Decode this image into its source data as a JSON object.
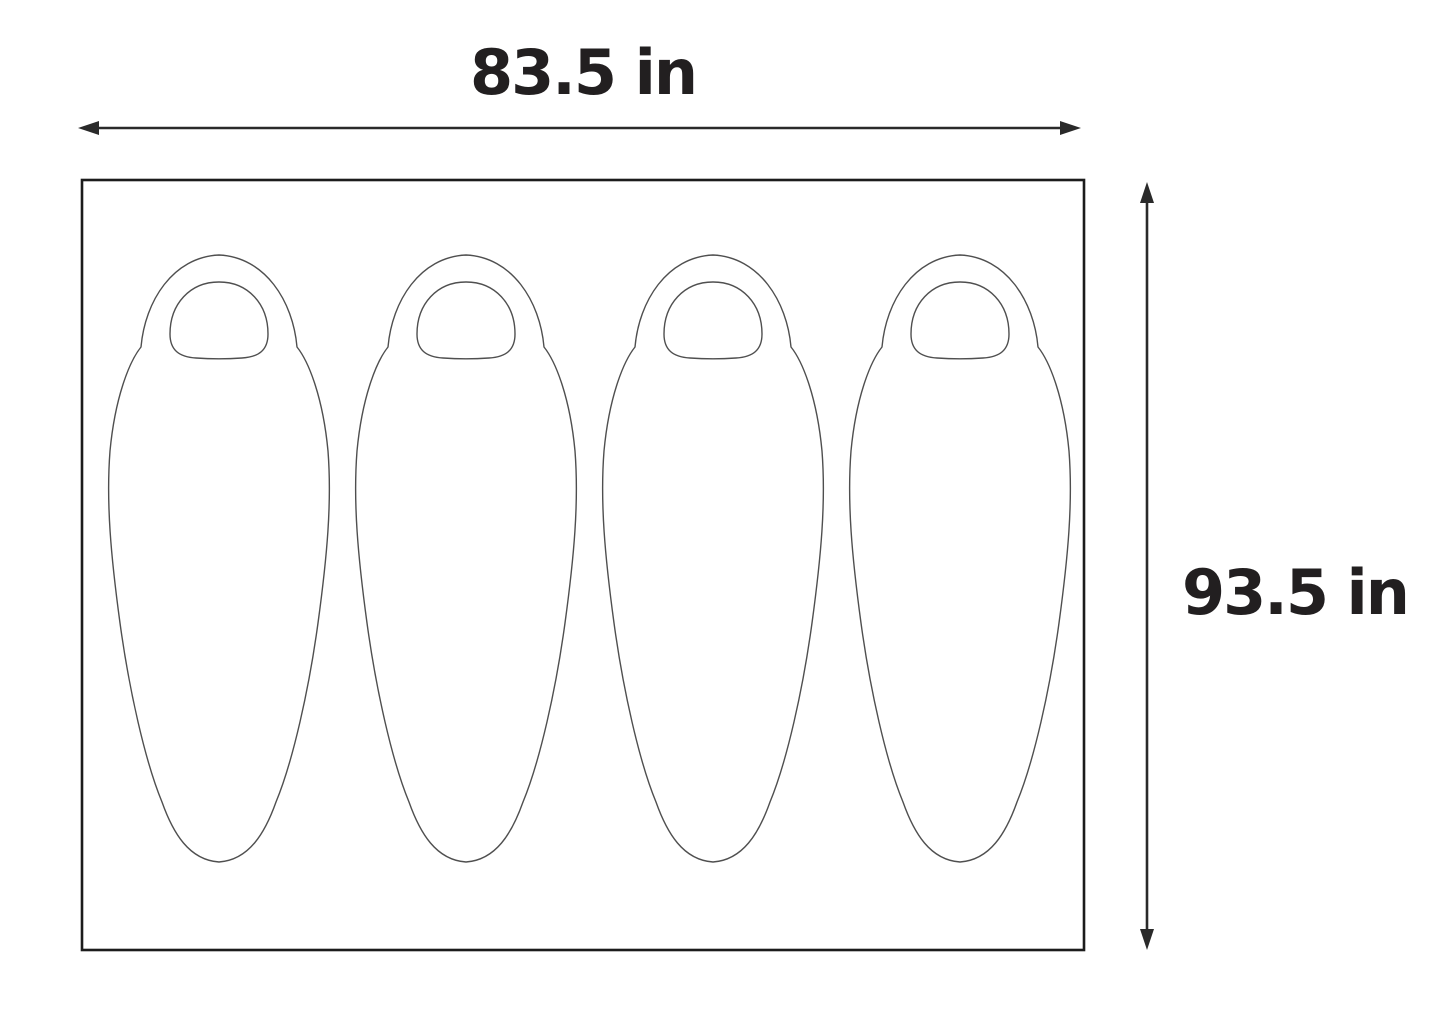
{
  "diagram": {
    "dimensions": {
      "width_label": "83.5 in",
      "height_label": "93.5 in"
    },
    "sleeping_bags": {
      "count": 4,
      "centers_x": [
        219,
        466,
        713,
        960
      ],
      "top_y": 255
    },
    "colors": {
      "bag_outline": "#4f4f4f",
      "frame": "#1c1c1c",
      "arrow": "#2a2a2a",
      "text": "#221f20",
      "background": "#ffffff"
    }
  }
}
